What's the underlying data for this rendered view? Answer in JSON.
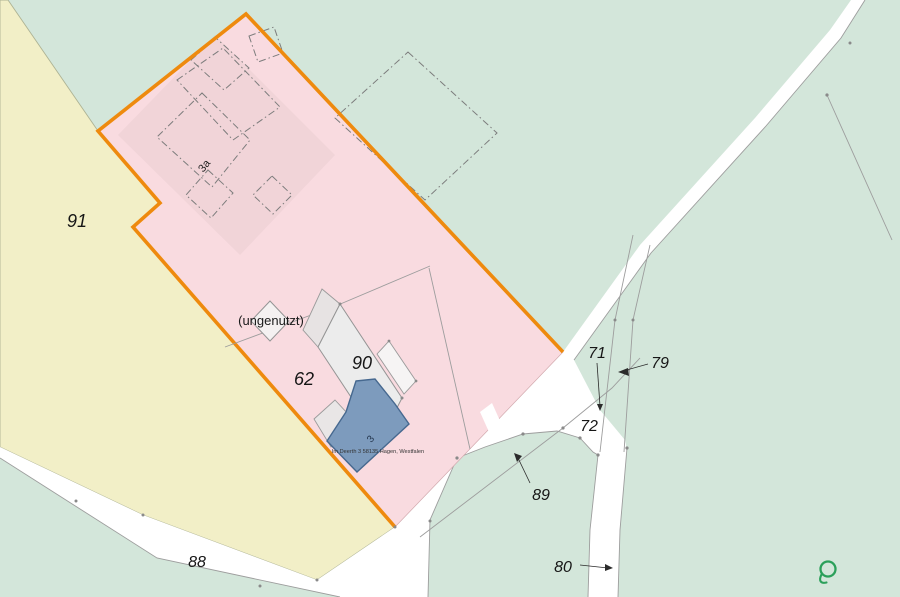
{
  "map": {
    "type": "cadastral-map",
    "parcel_labels": [
      {
        "text": "91"
      },
      {
        "text": "62"
      },
      {
        "text": "90"
      },
      {
        "text": "88"
      },
      {
        "text": "89"
      },
      {
        "text": "80"
      },
      {
        "text": "72"
      },
      {
        "text": "71"
      },
      {
        "text": "79"
      }
    ],
    "building_labels": [
      {
        "text": "3a"
      },
      {
        "text": "3"
      }
    ],
    "annotations": {
      "unused_label": "(ungenutzt)",
      "address_label": "Im Deerth 3 58135 Hagen, Westfalen"
    },
    "watermark": {
      "letter": "Q",
      "color": "#2ba05a"
    },
    "colors": {
      "background_green": "#d3e6da",
      "parcel_yellow": "#f2efc7",
      "parcel_pink": "#f9dbe0",
      "highlight_orange": "#ee8a0e",
      "building_blue": "#7d9bbd",
      "building_blue_border": "#46688f",
      "building_gray": "#ececec",
      "road_white": "#ffffff",
      "boundary_gray": "#9d9d9d",
      "watermark_green": "#2ba05a"
    }
  }
}
